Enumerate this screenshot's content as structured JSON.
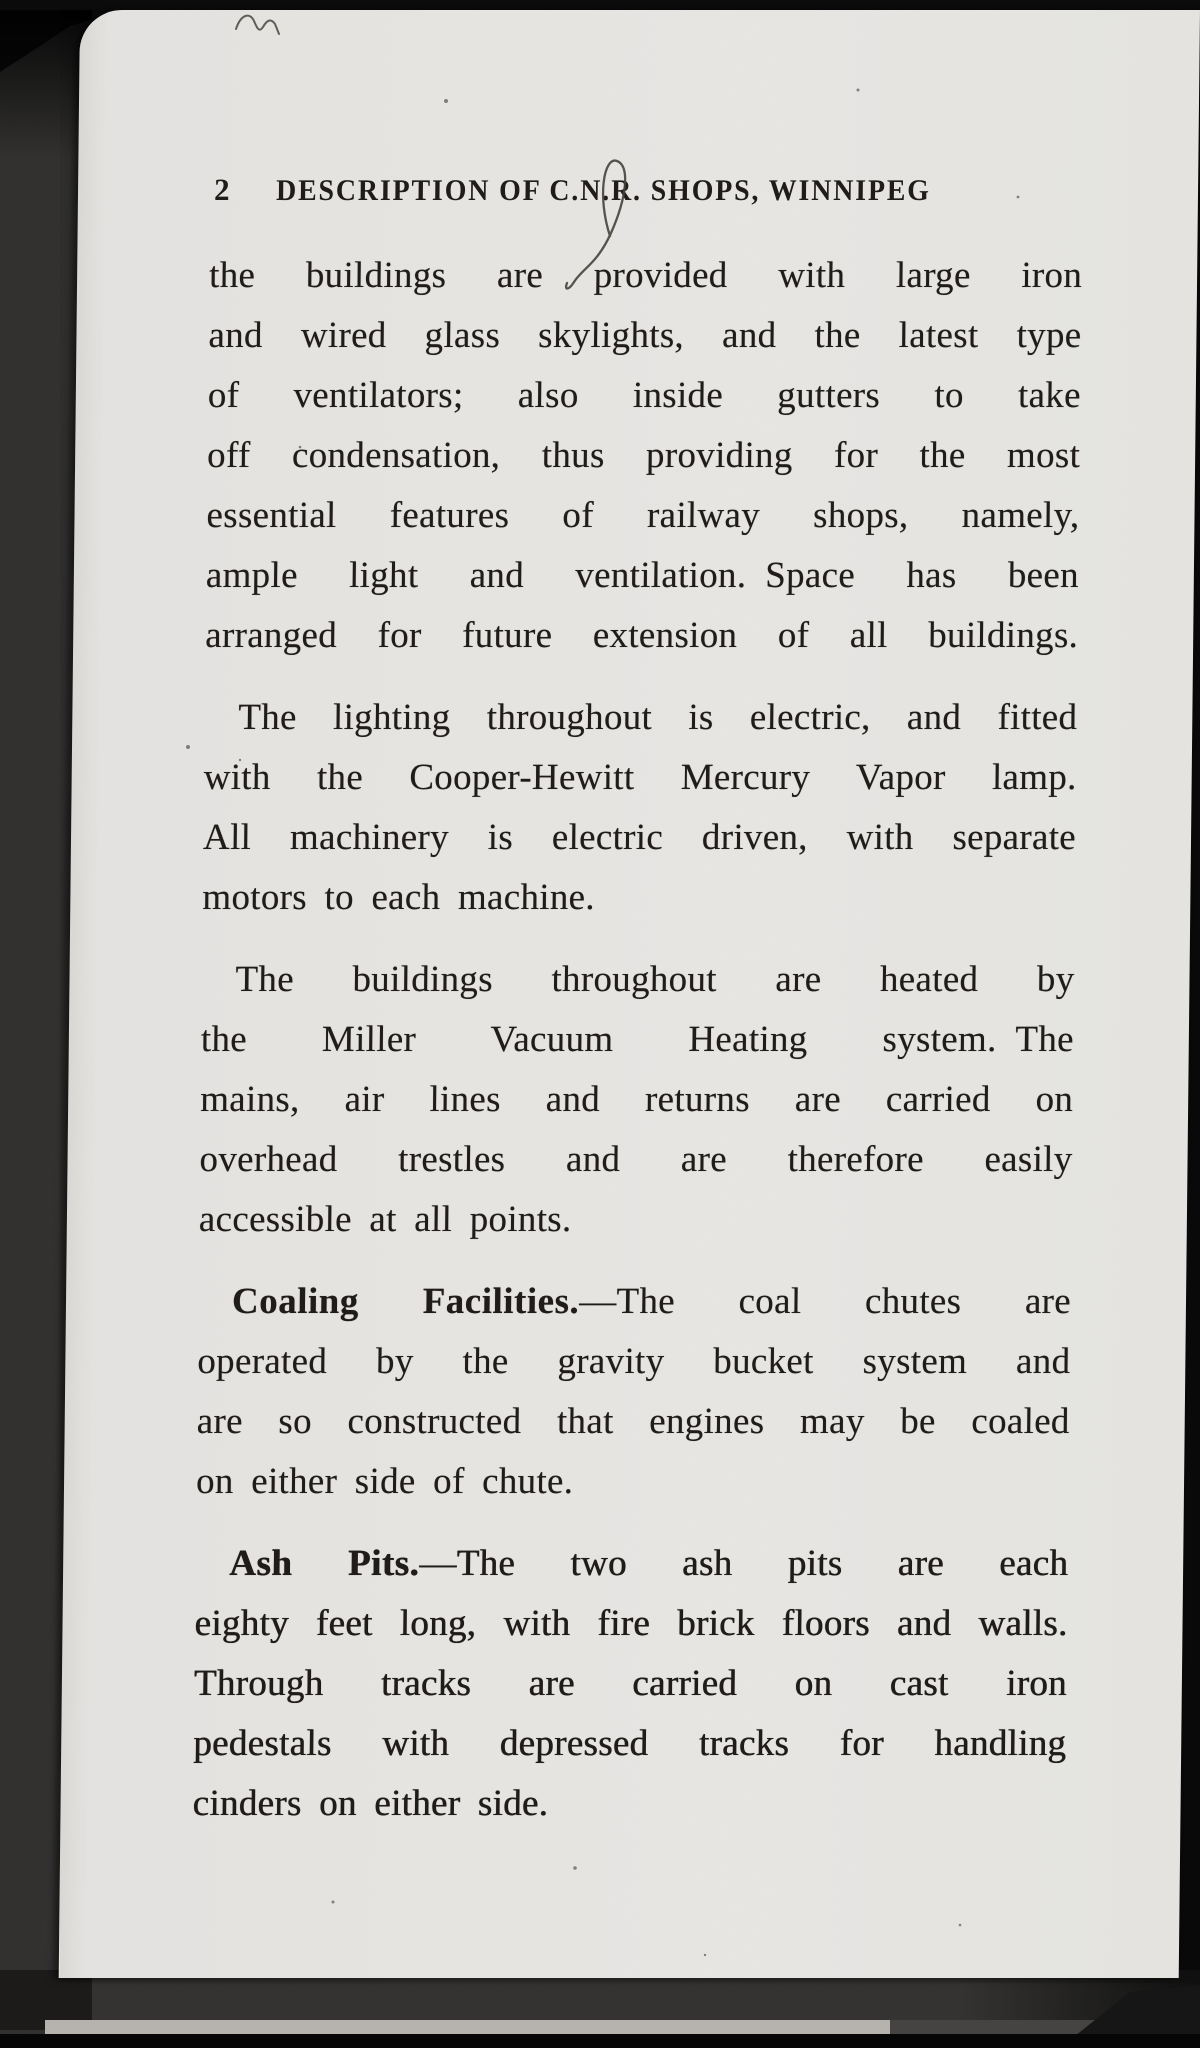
{
  "scan": {
    "description": "Photographed book page on dark background with gray book-edge borders",
    "ink_marks": [
      "top-squiggle",
      "pen-loop-over-CNR-initials"
    ],
    "colors": {
      "background": "#0a0a0a",
      "book_edge": "#5d5b58",
      "bottom_light_edge": "#b6b3ae",
      "paper": "#f5f4f1",
      "ink": "#211e1b"
    }
  },
  "page": {
    "number": "2",
    "header_title": "DESCRIPTION OF C.N.R. SHOPS, WINNIPEG",
    "paragraphs": [
      {
        "lines": [
          {
            "text": "the buildings are provided with large iron",
            "justify": true
          },
          {
            "text": "and wired glass skylights, and the latest type",
            "justify": true
          },
          {
            "text": "of ventilators; also inside gutters to take",
            "justify": true
          },
          {
            "text": "off condensation, thus providing for the most",
            "justify": true
          },
          {
            "text": "essential features of railway shops, namely,",
            "justify": true
          },
          {
            "text": "ample light and ventilation. Space has been",
            "justify": true
          },
          {
            "text": "arranged for future extension of all buildings.",
            "justify": true
          }
        ]
      },
      {
        "lines": [
          {
            "text": "The lighting throughout is electric, and fitted",
            "justify": true,
            "indent": true
          },
          {
            "text": "with the Cooper-Hewitt Mercury Vapor lamp.",
            "justify": true
          },
          {
            "text": "All machinery is electric driven, with separate",
            "justify": true
          },
          {
            "text": "motors to each machine."
          }
        ]
      },
      {
        "lines": [
          {
            "text": "The buildings throughout are heated by",
            "justify": true,
            "indent": true
          },
          {
            "text": "the Miller Vacuum Heating system. The",
            "justify": true
          },
          {
            "text": "mains, air lines and returns are carried on",
            "justify": true
          },
          {
            "text": "overhead trestles and are therefore easily",
            "justify": true
          },
          {
            "text": "accessible at all points."
          }
        ]
      },
      {
        "lines": [
          {
            "bold": "Coaling Facilities.",
            "text": "—The coal chutes are",
            "justify": true,
            "indent": true
          },
          {
            "text": "operated by the gravity bucket system and",
            "justify": true
          },
          {
            "text": "are so constructed that engines may be coaled",
            "justify": true
          },
          {
            "text": "on either side of chute."
          }
        ]
      },
      {
        "heavy": true,
        "lines": [
          {
            "bold": "Ash Pits.",
            "text": "—The two ash pits are each",
            "justify": true,
            "indent": true
          },
          {
            "text": "eighty feet long, with fire brick floors and walls.",
            "justify": true
          },
          {
            "text": "Through tracks are carried on cast iron",
            "justify": true
          },
          {
            "text": "pedestals with depressed tracks for handling",
            "justify": true
          },
          {
            "text": "cinders on either side."
          }
        ]
      }
    ]
  }
}
